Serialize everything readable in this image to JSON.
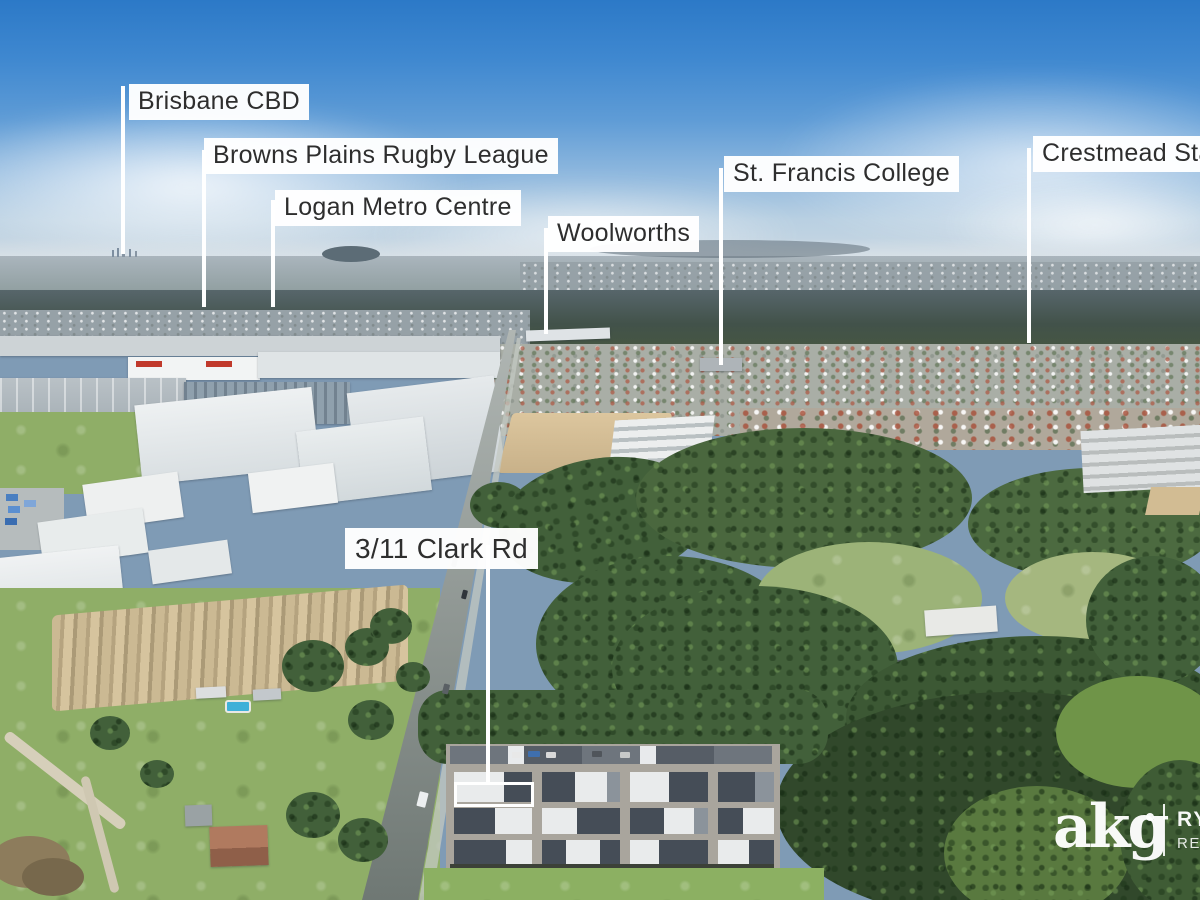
{
  "meta": {
    "description": "Aerial drone marketing photo of a suburban and industrial area with location callouts"
  },
  "callouts": {
    "brisbane_cbd": {
      "label": "Brisbane CBD"
    },
    "browns_plains_rugby_league": {
      "label": "Browns Plains Rugby League"
    },
    "logan_metro_centre": {
      "label": "Logan Metro Centre"
    },
    "woolworths": {
      "label": "Woolworths"
    },
    "st_francis_college": {
      "label": "St. Francis College"
    },
    "crestmead_state": {
      "label": "Crestmead Sta"
    },
    "property": {
      "label": "3/11 Clark Rd"
    }
  },
  "branding": {
    "agency_logo": "akg",
    "partner_top": "RY",
    "partner_bottom": "REA"
  },
  "palette": {
    "sky_top": "#2c79c7",
    "sky_horizon": "#ccd8e1",
    "label_bg": "#ffffff",
    "label_text": "#2e2e2e",
    "leader_line": "#ffffff",
    "bushland_green": "#42603a",
    "field_green": "#8fae67",
    "roof_dark": "#454d57",
    "roof_white": "#e9ebec",
    "sand": "#d4bd94",
    "road_grey": "#8d9693",
    "logo_white": "#ffffff"
  }
}
